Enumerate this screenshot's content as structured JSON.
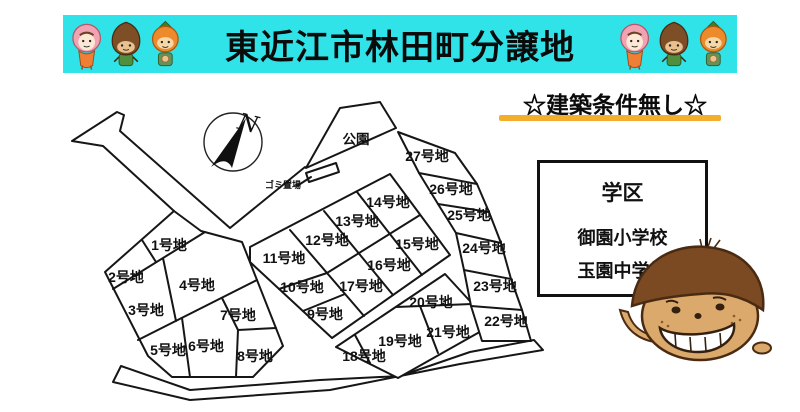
{
  "banner": {
    "title": "東近江市林田町分譲地"
  },
  "subtitle": {
    "text": "☆建築条件無し☆"
  },
  "school_box": {
    "title": "学区",
    "elementary": "御園小学校",
    "junior_high": "玉園中学校"
  },
  "map": {
    "park_label": "公園",
    "garbage_label": "ゴミ置場",
    "compass_label": "N",
    "lots": [
      {
        "label": "1号地",
        "x": 169,
        "y": 245
      },
      {
        "label": "2号地",
        "x": 126,
        "y": 277
      },
      {
        "label": "3号地",
        "x": 146,
        "y": 310
      },
      {
        "label": "4号地",
        "x": 197,
        "y": 285
      },
      {
        "label": "5号地",
        "x": 168,
        "y": 350
      },
      {
        "label": "6号地",
        "x": 206,
        "y": 346
      },
      {
        "label": "7号地",
        "x": 238,
        "y": 315
      },
      {
        "label": "8号地",
        "x": 255,
        "y": 356
      },
      {
        "label": "9号地",
        "x": 325,
        "y": 314
      },
      {
        "label": "10号地",
        "x": 302,
        "y": 287
      },
      {
        "label": "11号地",
        "x": 284,
        "y": 258
      },
      {
        "label": "12号地",
        "x": 327,
        "y": 240
      },
      {
        "label": "13号地",
        "x": 357,
        "y": 221
      },
      {
        "label": "14号地",
        "x": 388,
        "y": 202
      },
      {
        "label": "15号地",
        "x": 417,
        "y": 244
      },
      {
        "label": "16号地",
        "x": 389,
        "y": 265
      },
      {
        "label": "17号地",
        "x": 361,
        "y": 286
      },
      {
        "label": "18号地",
        "x": 364,
        "y": 356
      },
      {
        "label": "19号地",
        "x": 400,
        "y": 341
      },
      {
        "label": "20号地",
        "x": 431,
        "y": 302
      },
      {
        "label": "21号地",
        "x": 448,
        "y": 332
      },
      {
        "label": "22号地",
        "x": 506,
        "y": 321
      },
      {
        "label": "23号地",
        "x": 495,
        "y": 286
      },
      {
        "label": "24号地",
        "x": 484,
        "y": 248
      },
      {
        "label": "25号地",
        "x": 469,
        "y": 215
      },
      {
        "label": "26号地",
        "x": 451,
        "y": 189
      },
      {
        "label": "27号地",
        "x": 427,
        "y": 156
      }
    ]
  },
  "colors": {
    "banner_bg": "#2fe3e9",
    "underline": "#f3ae2b",
    "line": "#161616"
  }
}
